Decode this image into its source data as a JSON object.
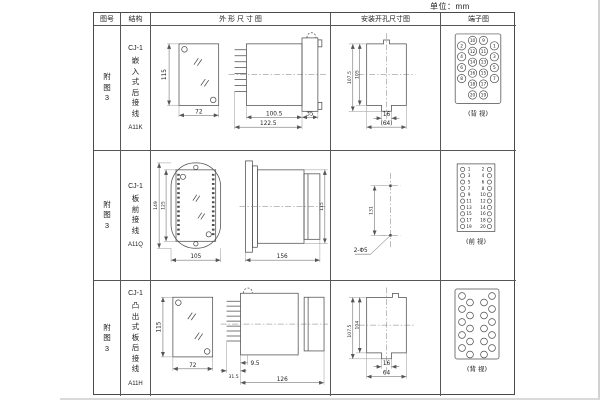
{
  "unit_label": "单位：mm",
  "header": {
    "fig_no": "图号",
    "structure": "结构",
    "outline": "外 形 尺 寸 图",
    "install": "安装开孔尺寸图",
    "terminal": "端子图"
  },
  "rows": [
    {
      "fig": "附\n图\n3",
      "model": "CJ-1",
      "name": "嵌\n入\n式\n后\n接\n线",
      "code": "A11K",
      "front": {
        "h": "115",
        "w": "72"
      },
      "side": {
        "body": "100.5",
        "overall": "122.5",
        "flange": "35"
      },
      "install": {
        "h_outer": "107.5",
        "h_inner": "105",
        "slot_w": "16",
        "span_w": "(64)"
      },
      "terminal": {
        "caption": "(背 视)",
        "inner_left": [
          "10",
          "12",
          "14",
          "16",
          "18",
          "20"
        ],
        "inner_right": [
          "9",
          "11",
          "13",
          "15",
          "17",
          "19"
        ],
        "outer_left": [
          "2",
          "4",
          "6",
          "8"
        ],
        "outer_right": [
          "1",
          "3",
          "5",
          "7"
        ]
      }
    },
    {
      "fig": "附\n图\n3",
      "model": "CJ-1",
      "name": "板\n前\n接\n线",
      "code": "A11Q",
      "front": {
        "h_outer": "149",
        "h_inner": "125",
        "w": "105"
      },
      "side": {
        "length": "156",
        "h": "115"
      },
      "install": {
        "spacing": "131",
        "holes": "2-Φ5"
      },
      "terminal": {
        "caption": "(前 视)",
        "left": [
          "1",
          "3",
          "5",
          "7",
          "9",
          "11",
          "13",
          "15",
          "17",
          "19"
        ],
        "right": [
          "2",
          "4",
          "6",
          "8",
          "10",
          "12",
          "14",
          "16",
          "18",
          "20"
        ]
      }
    },
    {
      "fig": "附\n图\n3",
      "model": "CJ-1",
      "name": "凸\n出\n式\n板\n后\n接\n线",
      "code": "A11H",
      "front": {
        "h": "115",
        "w": "72"
      },
      "side": {
        "pins": "31.5",
        "inset": "9.5",
        "overall": "126"
      },
      "install": {
        "h_outer": "107.5",
        "h_inner": "104",
        "slot_w": "16",
        "span_w": "64"
      },
      "terminal": {
        "caption": "(背 视)"
      }
    }
  ]
}
